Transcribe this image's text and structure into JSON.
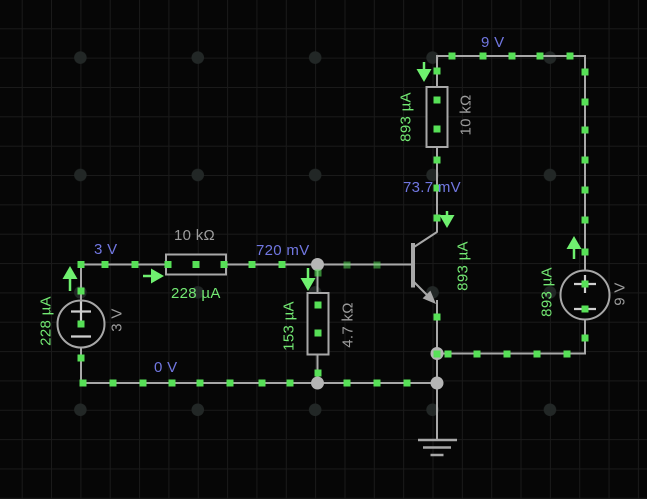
{
  "app": {
    "view": "circuit simulator schematic canvas"
  },
  "colors": {
    "background": "#060606",
    "grid_line": "#1a1a1a",
    "grid_dot": "#222726",
    "wire": "#a8a8a8",
    "junction_node": "#b5b5b5",
    "current_dot": "#57e057",
    "current_arrow": "#6ff06f",
    "voltage_label": "#7177e1",
    "current_label": "#73e873",
    "component_label": "#9c9c9c"
  },
  "circuit": {
    "sources": [
      {
        "name": "left battery",
        "value": "3 V"
      },
      {
        "name": "right battery",
        "value": "9 V"
      }
    ],
    "resistors": [
      {
        "name": "base resistor",
        "value": "10 kΩ"
      },
      {
        "name": "emitter-branch resistor",
        "value": "4.7 kΩ"
      },
      {
        "name": "collector resistor",
        "value": "10 kΩ"
      }
    ],
    "transistor": {
      "type": "NPN"
    },
    "ground": {
      "present": true
    },
    "node_voltages": [
      "3 V",
      "720 mV",
      "0 V",
      "9 V",
      "73.7 mV"
    ],
    "branch_currents": [
      "228 µA",
      "153 µA",
      "893 µA"
    ]
  },
  "labels": [
    {
      "text": "3 V",
      "kind": "node-voltage"
    },
    {
      "text": "10 kΩ",
      "kind": "component-value"
    },
    {
      "text": "720 mV",
      "kind": "node-voltage"
    },
    {
      "text": "228 µA",
      "kind": "branch-current"
    },
    {
      "text": "0 V",
      "kind": "node-voltage"
    },
    {
      "text": "9 V",
      "kind": "node-voltage"
    },
    {
      "text": "73.7 mV",
      "kind": "node-voltage"
    },
    {
      "text": "228 µA",
      "kind": "branch-current"
    },
    {
      "text": "3 V",
      "kind": "component-value"
    },
    {
      "text": "153 µA",
      "kind": "branch-current"
    },
    {
      "text": "4.7 kΩ",
      "kind": "component-value"
    },
    {
      "text": "893 µA",
      "kind": "branch-current"
    },
    {
      "text": "893 µA",
      "kind": "branch-current"
    },
    {
      "text": "10 kΩ",
      "kind": "component-value"
    },
    {
      "text": "893 µA",
      "kind": "branch-current"
    },
    {
      "text": "9 V",
      "kind": "component-value"
    }
  ]
}
